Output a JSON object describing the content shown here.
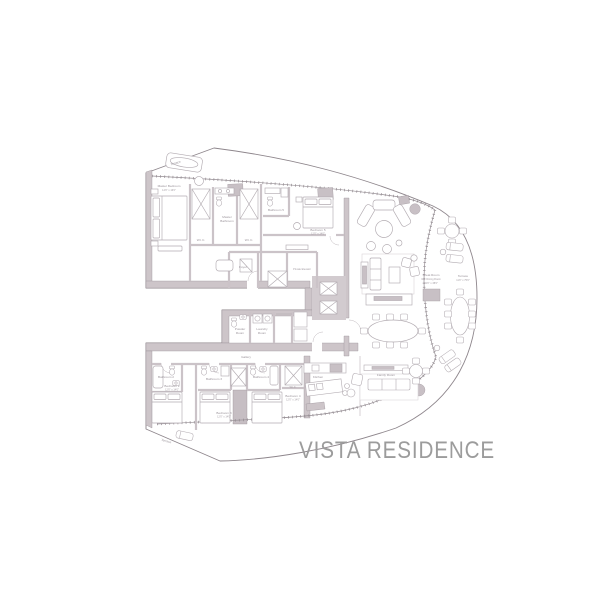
{
  "title": "VISTA RESIDENCE",
  "colors": {
    "wall_fill": "#cdc5c9",
    "wall_line": "#8e868c",
    "furniture_line": "#b2abb1",
    "label_text": "#9a939a",
    "title_text": "#9c9c9c",
    "column_fill": "#c8c0c5",
    "background": "#ffffff"
  },
  "labels": {
    "terrace_top": "Terrace",
    "master_bedroom": "Master Bedroom",
    "master_bedroom_dims": "14'0\" x 16'0\"",
    "wic_left": "W.I.C.",
    "wic_right": "W.I.C.",
    "master_bath_1": "Master",
    "master_bath_2": "Bathroom",
    "bathroom5": "Bathroom 5",
    "bedroom5": "Bedroom 5",
    "bedroom5_dims": "12'0\" x 14'0\"",
    "foyer": "Foyer",
    "private_elevator": "Private Elevator",
    "powder_1": "Powder",
    "powder_2": "Room",
    "laundry_1": "Laundry",
    "laundry_2": "Room",
    "gallery": "Gallery",
    "kitchen": "Kitchen",
    "family_room": "Family Room",
    "great_room_1": "Great Room",
    "great_room_2": "Incl. Dining Room",
    "great_room_3": "24'0\" x 38'0\"",
    "terrace_right_1": "Terrace",
    "terrace_right_2": "11'0\" x 75'0\"",
    "bathroom2": "Bathroom 2",
    "bedroom2": "Bedroom 2",
    "bedroom2_dims": "12'0\" x 14'0\"",
    "bathroom3": "Bathroom 3",
    "bedroom3": "Bedroom 3",
    "bedroom3_dims": "12'0\" x 14'0\"",
    "bathroom4": "Bathroom 4",
    "bedroom4": "Bedroom 4",
    "bedroom4_dims": "12'0\" x 14'0\"",
    "wic_lower": "W.I.C.",
    "terrace_bottom": "Terrace"
  }
}
